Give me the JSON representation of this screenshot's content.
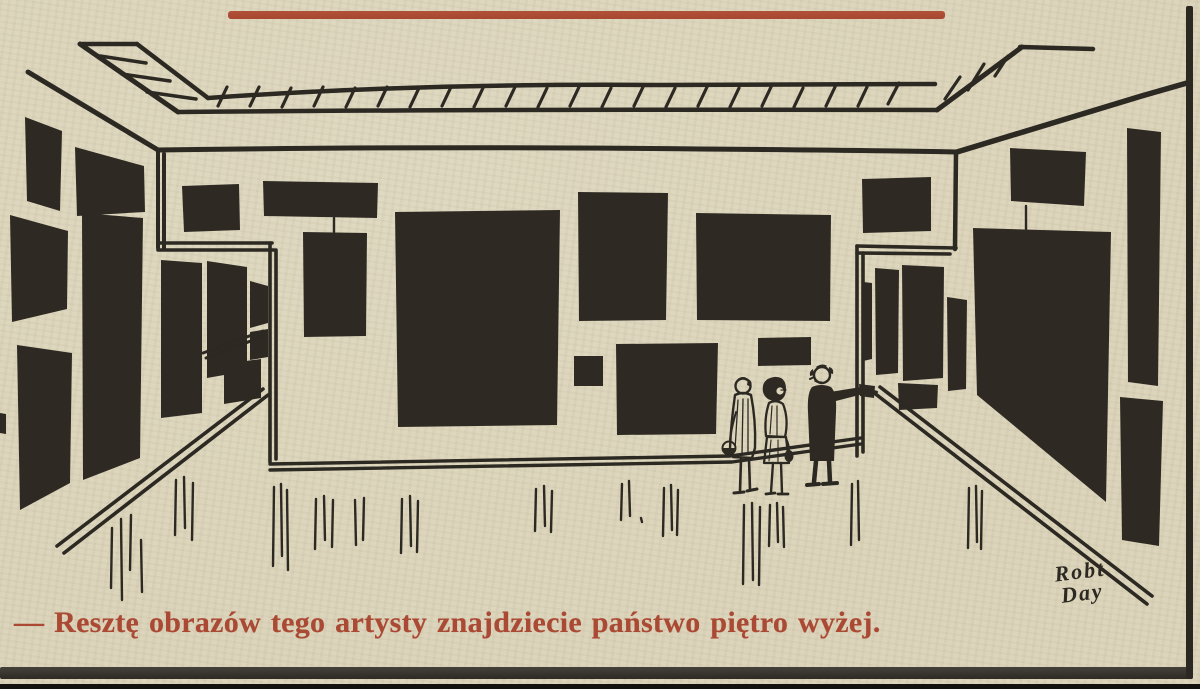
{
  "palette": {
    "paper": "#dcd5bb",
    "ink": "#2c2822",
    "accent_red": "#ab4a34"
  },
  "top_rule": {
    "color": "#ab4a34"
  },
  "cartoon": {
    "description": "Line-drawn art gallery room; every wall is hung with dark abstract paintings; three small visitors stand at the right while a guide points further on",
    "signature_line1": "Robt",
    "signature_line2": "Day"
  },
  "caption": {
    "text": "— Resztę obrazów tego artysty znajdziecie państwo piętro wyżej.",
    "color": "#ab4a34"
  }
}
